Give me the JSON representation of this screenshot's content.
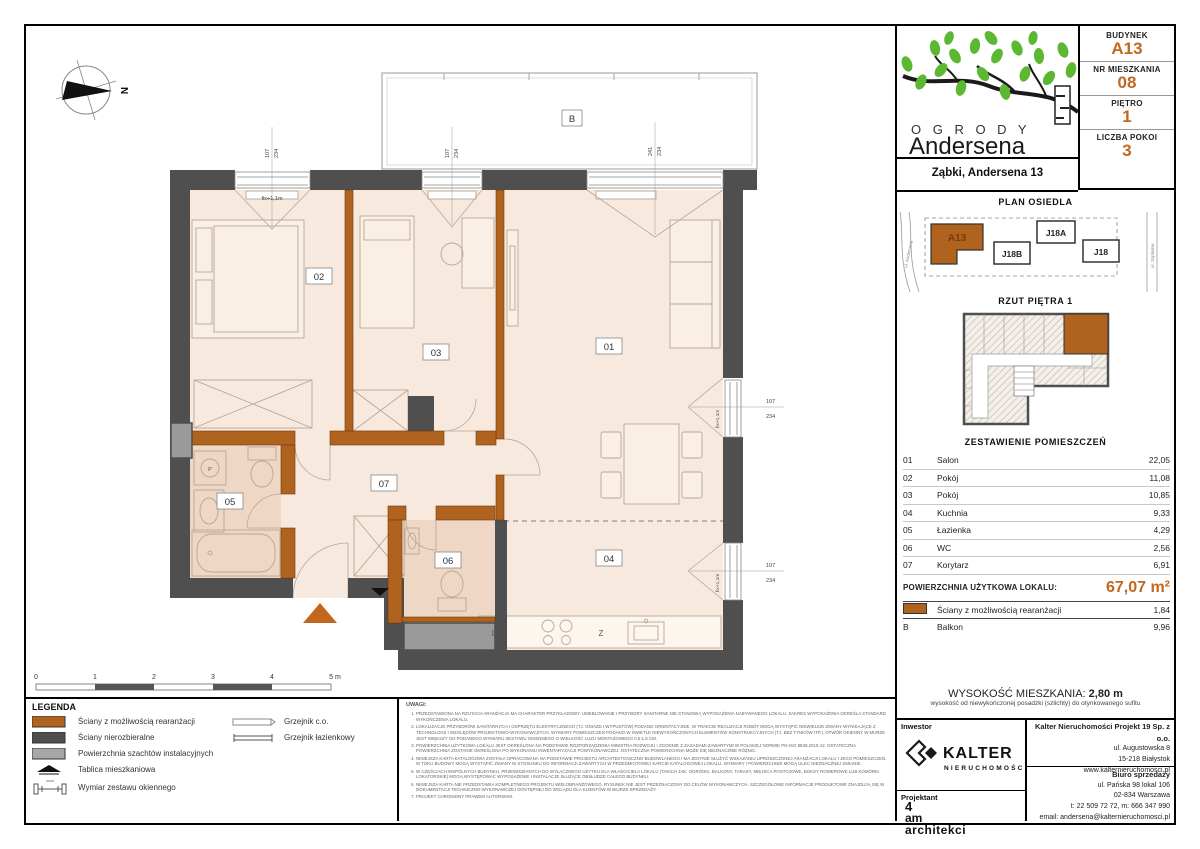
{
  "header": {
    "budynek_label": "BUDYNEK",
    "budynek": "A13",
    "mieszkanie_label": "NR MIESZKANIA",
    "mieszkanie": "08",
    "pietro_label": "PIĘTRO",
    "pietro": "1",
    "pokoje_label": "LICZBA POKOI",
    "pokoje": "3"
  },
  "logo": {
    "line1": "O G R O D Y",
    "line2": "Andersena",
    "location": "Ząbki, Andersena 13"
  },
  "estate_plan": {
    "title": "PLAN OSIEDLA",
    "blocks": [
      "A13",
      "J18B",
      "J18A",
      "J18"
    ],
    "street_left": "ul. Andersena",
    "street_right": "ul. Szpitalna"
  },
  "floor_overview": {
    "title": "RZUT PIĘTRA 1"
  },
  "rooms_table": {
    "title": "ZESTAWIENIE POMIESZCZEŃ",
    "rows": [
      {
        "no": "01",
        "name": "Salon",
        "area": "22,05"
      },
      {
        "no": "02",
        "name": "Pokój",
        "area": "11,08"
      },
      {
        "no": "03",
        "name": "Pokój",
        "area": "10,85"
      },
      {
        "no": "04",
        "name": "Kuchnia",
        "area": "9,33"
      },
      {
        "no": "05",
        "name": "Łazienka",
        "area": "4,29"
      },
      {
        "no": "06",
        "name": "WC",
        "area": "2,56"
      },
      {
        "no": "07",
        "name": "Korytarz",
        "area": "6,91"
      }
    ],
    "total_label": "POWIERZCHNIA UŻYTKOWA LOKALU:",
    "total_value": "67,07 m²",
    "walls_row": {
      "name": "Ściany z możliwością rearanżacji",
      "area": "1,84"
    },
    "balcony_row": {
      "no": "B",
      "name": "Balkon",
      "area": "9,96"
    }
  },
  "height_info": {
    "label": "WYSOKOŚĆ MIESZKANIA: ",
    "value": "2,80 m",
    "note": "wysokość od niewykończonej posadzki (szlichty) do otynkowanego sufitu"
  },
  "developer": {
    "inwestor_label": "Inwestor",
    "brand": "KALTER",
    "brand_sub": "NIERUCHOMOŚCI",
    "company": "Kalter Nieruchomości Projekt 19 Sp. z o.o.",
    "address1": "ul. Augustowska 8",
    "address2": "15-218 Białystok",
    "address3": "www.kalternieruchomosci.pl",
    "projektant_label": "Projektant",
    "studio1": "4",
    "studio2": "am",
    "studio3": "architekci",
    "sales_label": "Biuro sprzedaży",
    "sales1": "ul. Pańska 98 lokal 106",
    "sales2": "02-834 Warszawa",
    "sales3": "t: 22 509 72 72, m: 666 347 990",
    "sales4": "email: andersena@kalternieruchomosci.pl"
  },
  "legend": {
    "title": "LEGENDA",
    "item1": "Ściany z możliwością rearanżacji",
    "item2": "Ściany nierozbieralne",
    "item3": "Powierzchnia szachtów instalacyjnych",
    "item4": "Tablica mieszkaniowa",
    "item5": "Wymiar zestawu okiennego",
    "item6": "Grzejnik c.o.",
    "item7": "Grzejnik łazienkowy"
  },
  "notes": {
    "title": "UWAGI:",
    "items": [
      "PRZEDSTAWIONA NA RZUTACH ARANŻACJA MA CHARAKTER PRZYKŁADOWY. UMEBLOWANIE I PRZYBORY SANITARNE NIE STANOWIĄ WYPOSAŻENIA NABYWANEGO LOKALU. ZAKRES WYPOSAŻENIA OKREŚLA STANDARD WYKOŃCZENIA LOKALU.",
      "LOKALIZACJE PRZYBORÓW SANITARNYCH I OSPRZĘTU ELEKTRYCZNEGO (TJ. GNIAZD I WYPUSTÓW) PODANO ORIENTACYJNIE. W TRAKCIE REALIZACJI ROBÓT MOGĄ WYSTĄPIĆ NIEWIELKIE ZMIANY WYNIKAJĄCE Z TECHNOLOGII I WZGLĘDÓW PROJEKTOWO-WYKONAWCZYCH. WYMIARY POMIESZCZEŃ PODANO W ŚWIETLE NIEWYKOŃCZONYCH ELEMENTÓW KONSTRUKCYJNYCH (TJ. BEZ TYNKÓW ITP.). OTWÓR OKIENNY W MURZE JEST WIĘKSZY OD PODANEGO WYMIARU ZESTAWU OKIENNEGO O WIELKOŚĆ LUZU MONTAŻOWEGO 0,5-1,5 CM.",
      "POWIERZCHNIA UŻYTKOWA LOKALU JEST OKREŚLONA NA PODSTAWIE ROZPORZĄDZENIA MINISTRA ROZWOJU I ZGODNIE Z ZASADAMI ZAWARTYMI W POLSKIEJ NORMIE PN-ISO 9836:2015-12. OSTATECZNA POWIERZCHNIA ZOSTANIE OKREŚLONA PO WYKONANIU INWENTARYZACJI POWYKONAWCZEJ. OSTATECZNA POWIERZCHNIA MOŻE SIĘ NIEZNACZNIE RÓŻNIĆ.",
      "NINIEJSZA KARTA KATALOGOWA ZOSTAŁA OPRACOWANA NA PODSTAWIE PROJEKTU ARCHITEKTONICZNO-BUDOWLANEGO I MA JEDYNIE SŁUŻYĆ WSKAZANIU UPROSZCZONEJ ARANŻACJI LOKALU I JEGO POMIESZCZEŃ. W TOKU BUDOWY MOGĄ WYSTĄPIĆ ZMIANY W STOSUNKU DO INFORMACJI ZAWARTYCH W PRZEDMIOTOWEJ KARCIE KATALOGOWEJ LOKALU. WYMIARY I POWIERZCHNIE MOGĄ ULEC NIEZNACZNEJ ZMIANIE.",
      "W CZĘŚCIACH WSPÓLNYCH BUDYNKU, PRZEWIDZIANYCH DO WYŁĄCZNEGO UŻYTKU DLA WŁAŚCICIELA LOKALU (TAKICH JAK: OGRÓDKI, BALKONY, TARASY, MIEJSCA POSTOJOWE, BOKSY ROWEROWE LUB KOMÓRKI LOKATORSKIE) MOGĄ WYSTĘPOWAĆ WYPOSAŻENIE I INSTALACJE SŁUŻĄCE OBSŁUDZE CAŁEGO BUDYNKU.",
      "NINIEJSZA KARTA NIE PRZEDSTAWIA KOMPLETNEGO PROJEKTU WIELOBRANŻOWEGO. RYSUNEK NIE JEST PRZEZNACZONY DO CELÓW WYKONAWCZYCH. SZCZEGÓŁOWE INFORMACJE PRODUKTOWE ZNAJDUJĄ SIĘ W DOKUMENTACJI TECHNICZNO-WYKONAWCZEJ DOSTĘPNEJ DO WGLĄDU DLA KLIENTÓW W BIURZE SPRZEDAŻY.",
      "PROJEKT CHRONIONY PRAWEM AUTORSKIM."
    ]
  },
  "plan": {
    "compass": "N",
    "tags": {
      "t01": "01",
      "t02": "02",
      "t03": "03",
      "t04": "04",
      "t05": "05",
      "t06": "06",
      "t07": "07",
      "balkon": "B"
    },
    "dims": {
      "win1w": "107",
      "win1h": "234",
      "win2w": "107",
      "win2h": "234",
      "balw": "241",
      "balh": "234",
      "r1w": "107",
      "r1h": "234",
      "r2w": "107",
      "r2h": "234",
      "fix": "fix+1,1m"
    },
    "kitchen": {
      "fridge": "L",
      "sink": "Z"
    },
    "washer": "P",
    "scale": [
      "0",
      "1",
      "2",
      "3",
      "4",
      "5 m"
    ]
  },
  "colors": {
    "accent": "#c2671d",
    "wall_dark": "#4f4f4f",
    "wall_orange": "#b0631f",
    "floor": "#f7e9dd",
    "floor_wet": "#eed7c4",
    "shaft": "#9a9a9a",
    "leaf": "#5cb832"
  }
}
